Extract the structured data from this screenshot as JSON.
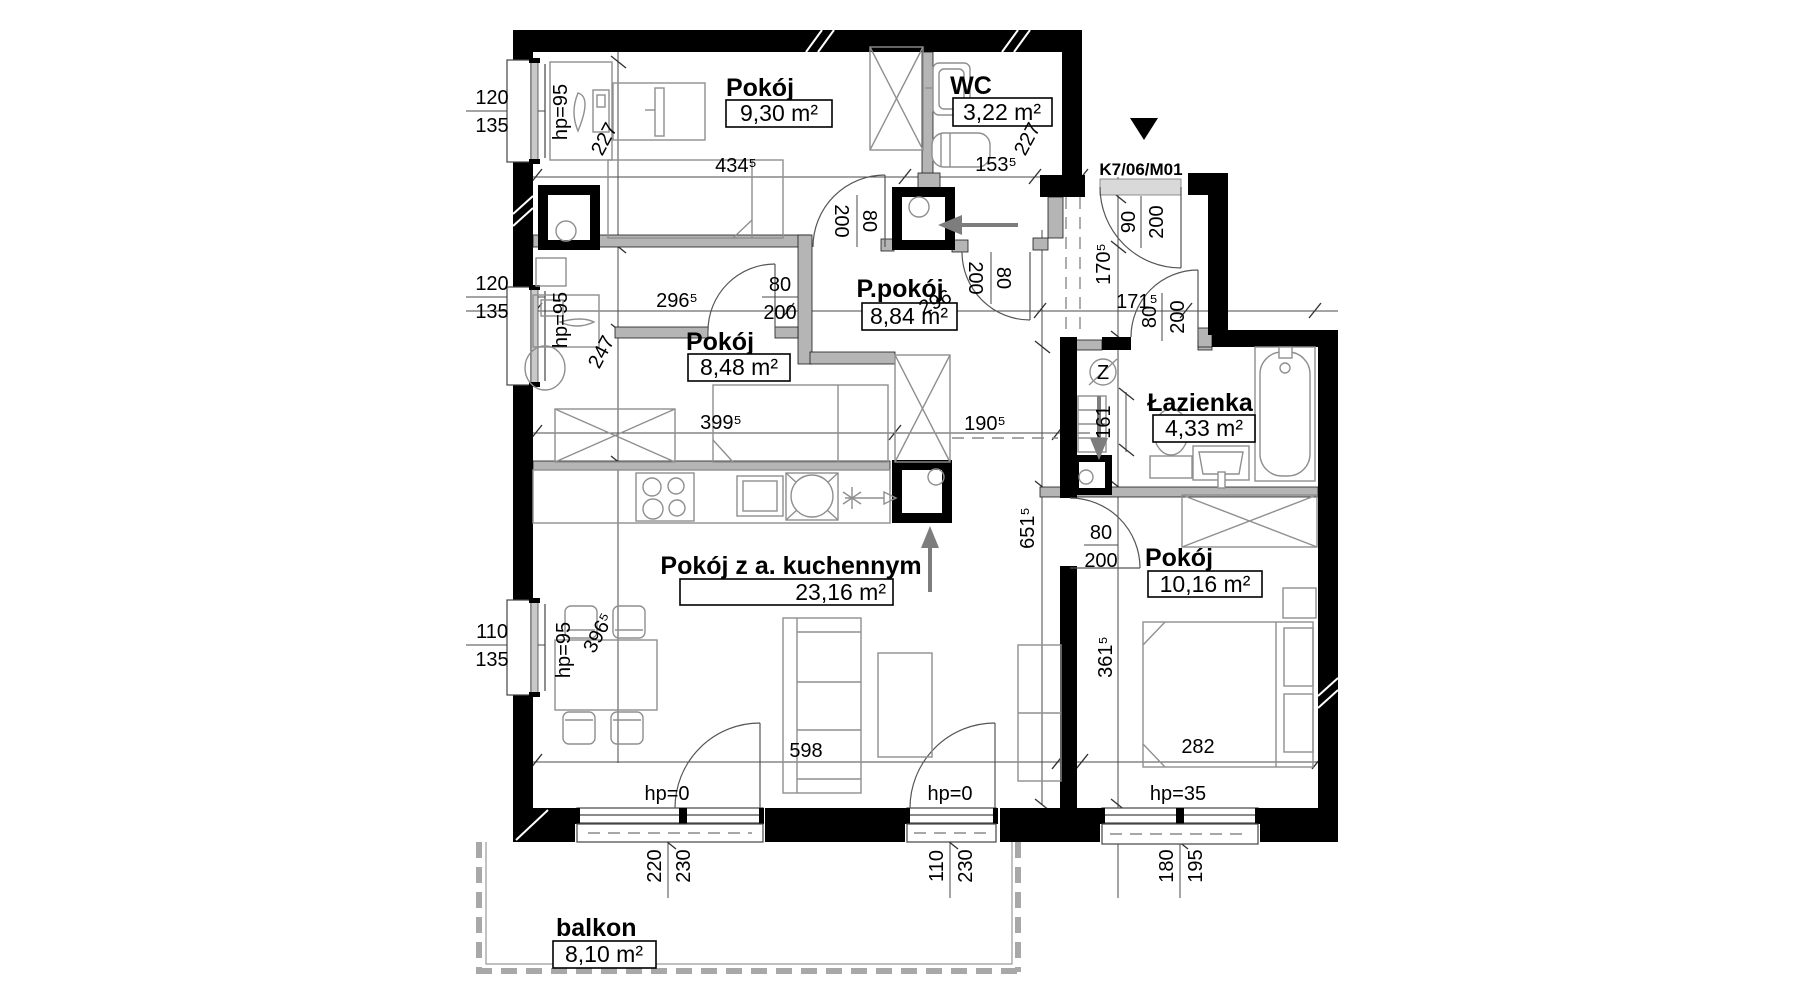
{
  "unit": {
    "id": "K7/06/M01"
  },
  "rooms": [
    {
      "name": "Pokój",
      "area": "9,30 m²"
    },
    {
      "name": "WC",
      "area": "3,22 m²"
    },
    {
      "name": "P.pokój",
      "area": "8,84 m²"
    },
    {
      "name": "Pokój",
      "area": "8,48 m²"
    },
    {
      "name": "Łazienka",
      "area": "4,33 m²"
    },
    {
      "name": "Pokój z a. kuchennym",
      "area": "23,16 m²"
    },
    {
      "name": "Pokój",
      "area": "10,16 m²"
    },
    {
      "name": "balkon",
      "area": "8,10 m²"
    }
  ],
  "dims": {
    "w434": "434⁵",
    "w153": "153⁵",
    "h227a": "227",
    "h227b": "227",
    "w296p": "296⁵",
    "w296": "296",
    "h247": "247",
    "w399": "399⁵",
    "w190": "190⁵",
    "h651": "651⁵",
    "h170": "170⁵",
    "w171": "171⁵",
    "h161": "161",
    "h361": "361⁵",
    "h396": "396⁵",
    "w598": "598",
    "w282": "282"
  },
  "windows": [
    {
      "width": "120",
      "sill": "135",
      "hp": "hp=95"
    },
    {
      "width": "120",
      "sill": "135",
      "hp": "hp=95"
    },
    {
      "width": "110",
      "sill": "135",
      "hp": "hp=95"
    },
    {
      "width": "220",
      "sill": "230",
      "hp": "hp=0"
    },
    {
      "width": "110",
      "sill": "230",
      "hp": "hp=0"
    },
    {
      "width": "180",
      "sill": "195",
      "hp": "hp=35"
    }
  ],
  "doors": [
    {
      "w": "80",
      "h": "200"
    },
    {
      "w": "80",
      "h": "200"
    },
    {
      "w": "80",
      "h": "200"
    },
    {
      "w": "90",
      "h": "200"
    },
    {
      "w": "80",
      "h": "200"
    },
    {
      "w": "80",
      "h": "200"
    }
  ],
  "symbols": {
    "z": "Z"
  }
}
